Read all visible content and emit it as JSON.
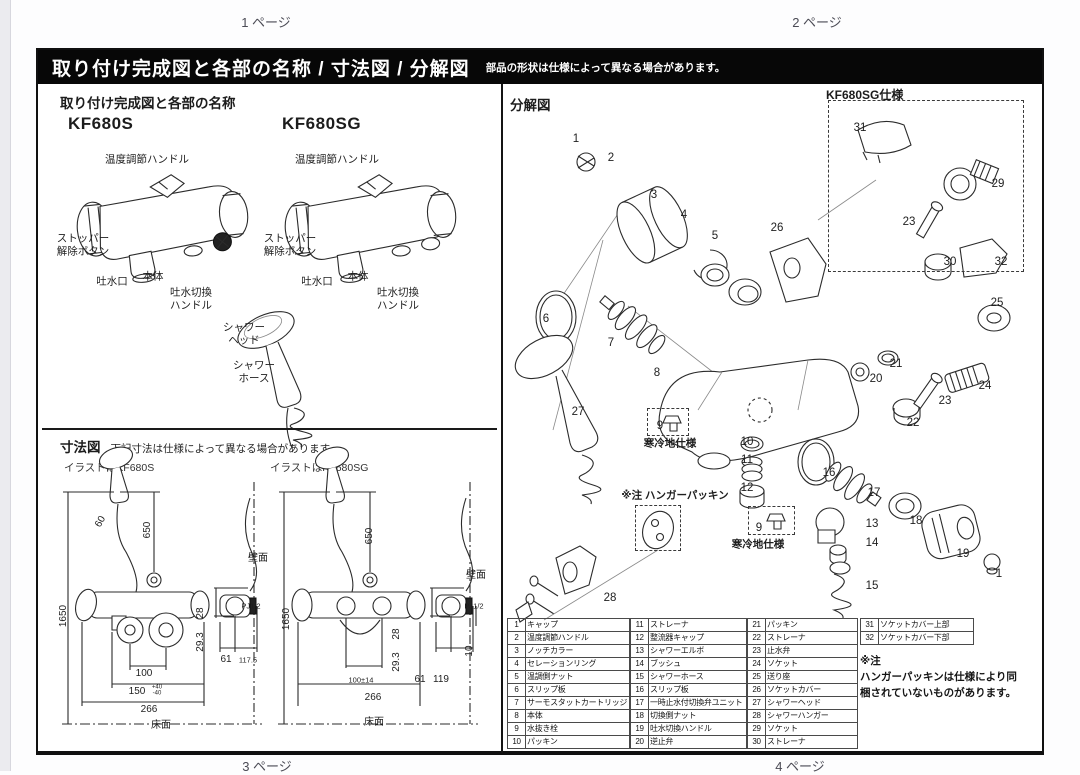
{
  "viewer": {
    "top_pages": [
      "1 ページ",
      "2 ページ"
    ],
    "bottom_pages": [
      "3 ページ",
      "4 ページ"
    ]
  },
  "header": {
    "title": "取り付け完成図と各部の名称 / 寸法図 / 分解図",
    "note": "部品の形状は仕様によって異なる場合があります。"
  },
  "completed": {
    "title": "取り付け完成図と各部の名称",
    "model_s": "KF680S",
    "model_sg": "KF680SG",
    "callouts": [
      {
        "t": "温度調節ハンドル",
        "x": 109,
        "y": 110
      },
      {
        "t": "ストッパー\n解除ボタン",
        "x": 45,
        "y": 195
      },
      {
        "t": "吐水口",
        "x": 74,
        "y": 232
      },
      {
        "t": "本体",
        "x": 115,
        "y": 227
      },
      {
        "t": "吐水切換\nハンドル",
        "x": 153,
        "y": 249
      },
      {
        "t": "温度調節ハンドル",
        "x": 299,
        "y": 110
      },
      {
        "t": "ストッパー\n解除ボタン",
        "x": 252,
        "y": 195
      },
      {
        "t": "吐水口",
        "x": 279,
        "y": 232
      },
      {
        "t": "本体",
        "x": 320,
        "y": 227
      },
      {
        "t": "吐水切換\nハンドル",
        "x": 360,
        "y": 249
      },
      {
        "t": "シャワー\nヘッド",
        "x": 206,
        "y": 284
      },
      {
        "t": "シャワー\nホース",
        "x": 216,
        "y": 322
      }
    ]
  },
  "dimensions": {
    "title": "寸法図",
    "note": "下記寸法は仕様によって異なる場合があります。",
    "caption_s": "イラストはKF680S",
    "caption_sg": "イラストはKF680SG",
    "wall_label": "壁面",
    "floor_label": "床面",
    "labels": [
      {
        "t": "650",
        "x": 110,
        "y": 480,
        "rot": 1
      },
      {
        "t": "1650",
        "x": 26,
        "y": 566,
        "rot": 1
      },
      {
        "t": "60",
        "x": 63,
        "y": 472,
        "cls": "dim-label rot60"
      },
      {
        "t": "100",
        "x": 106,
        "y": 624
      },
      {
        "t": "150",
        "x": 99,
        "y": 642
      },
      {
        "t": "+40\n-40",
        "x": 119,
        "y": 641,
        "cls": "tol"
      },
      {
        "t": "266",
        "x": 111,
        "y": 660
      },
      {
        "t": "28",
        "x": 163,
        "y": 563,
        "rot": 1
      },
      {
        "t": "29.3",
        "x": 163,
        "y": 592,
        "rot": 1
      },
      {
        "t": "61",
        "x": 188,
        "y": 610
      },
      {
        "t": "117.5",
        "x": 210,
        "y": 610,
        "cls": "dim-sm"
      },
      {
        "t": "PJ1/2",
        "x": 213,
        "y": 556,
        "cls": "dim-sm"
      },
      {
        "t": "壁面",
        "x": 220,
        "y": 509
      },
      {
        "t": "床面",
        "x": 123,
        "y": 676
      },
      {
        "t": "650",
        "x": 332,
        "y": 486,
        "rot": 1
      },
      {
        "t": "1650",
        "x": 249,
        "y": 569,
        "rot": 1
      },
      {
        "t": "100±14",
        "x": 323,
        "y": 630,
        "cls": "dim-sm"
      },
      {
        "t": "266",
        "x": 335,
        "y": 648
      },
      {
        "t": "28",
        "x": 359,
        "y": 584,
        "rot": 1
      },
      {
        "t": "29.3",
        "x": 359,
        "y": 612,
        "rot": 1
      },
      {
        "t": "61",
        "x": 382,
        "y": 630
      },
      {
        "t": "119",
        "x": 403,
        "y": 630
      },
      {
        "t": "10",
        "x": 432,
        "y": 601,
        "rot": 1
      },
      {
        "t": "PJ1/2",
        "x": 436,
        "y": 556,
        "cls": "dim-sm"
      },
      {
        "t": "壁面",
        "x": 438,
        "y": 526
      },
      {
        "t": "床面",
        "x": 336,
        "y": 673
      }
    ]
  },
  "exploded": {
    "title": "分解図",
    "sg_box_label": "KF680SG仕様",
    "cold_label_1": "寒冷地仕様",
    "cold_label_2": "寒冷地仕様",
    "hanger_label": "※注 ハンガーパッキン",
    "callouts": [
      {
        "n": "1",
        "x": 538,
        "y": 90
      },
      {
        "n": "2",
        "x": 573,
        "y": 109
      },
      {
        "n": "3",
        "x": 616,
        "y": 146
      },
      {
        "n": "4",
        "x": 646,
        "y": 166
      },
      {
        "n": "5",
        "x": 677,
        "y": 187
      },
      {
        "n": "26",
        "x": 739,
        "y": 179
      },
      {
        "n": "6",
        "x": 508,
        "y": 270
      },
      {
        "n": "7",
        "x": 573,
        "y": 294
      },
      {
        "n": "8",
        "x": 619,
        "y": 324
      },
      {
        "n": "27",
        "x": 540,
        "y": 363
      },
      {
        "n": "9",
        "x": 622,
        "y": 377
      },
      {
        "n": "10",
        "x": 709,
        "y": 393
      },
      {
        "n": "11",
        "x": 709,
        "y": 411
      },
      {
        "n": "12",
        "x": 709,
        "y": 439
      },
      {
        "n": "28",
        "x": 572,
        "y": 549
      },
      {
        "n": "9",
        "x": 721,
        "y": 479
      },
      {
        "n": "13",
        "x": 834,
        "y": 475
      },
      {
        "n": "14",
        "x": 834,
        "y": 494
      },
      {
        "n": "15",
        "x": 834,
        "y": 537
      },
      {
        "n": "16",
        "x": 791,
        "y": 424
      },
      {
        "n": "17",
        "x": 836,
        "y": 444
      },
      {
        "n": "18",
        "x": 878,
        "y": 472
      },
      {
        "n": "19",
        "x": 925,
        "y": 505
      },
      {
        "n": "1",
        "x": 961,
        "y": 525
      },
      {
        "n": "20",
        "x": 838,
        "y": 330
      },
      {
        "n": "21",
        "x": 858,
        "y": 315
      },
      {
        "n": "22",
        "x": 875,
        "y": 374
      },
      {
        "n": "23",
        "x": 907,
        "y": 352
      },
      {
        "n": "24",
        "x": 947,
        "y": 337
      },
      {
        "n": "25",
        "x": 959,
        "y": 254
      },
      {
        "n": "31",
        "x": 822,
        "y": 79
      },
      {
        "n": "29",
        "x": 960,
        "y": 135
      },
      {
        "n": "23",
        "x": 871,
        "y": 173
      },
      {
        "n": "30",
        "x": 912,
        "y": 213
      },
      {
        "n": "32",
        "x": 963,
        "y": 213
      }
    ],
    "labels": [
      {
        "t": "寒冷地仕様",
        "x": 632,
        "y": 394,
        "cls": "bold-label"
      },
      {
        "t": "※注 ハンガーパッキン",
        "x": 637,
        "y": 446,
        "cls": "bold-label"
      },
      {
        "t": "寒冷地仕様",
        "x": 720,
        "y": 495,
        "cls": "bold-label"
      }
    ],
    "table_groups": [
      {
        "start": 1,
        "items": [
          "キャップ",
          "温度調節ハンドル",
          "ノッチカラー",
          "セレーションリング",
          "温調側ナット",
          "スリップ板",
          "サーモスタットカートリッジ",
          "本体",
          "水抜き栓",
          "パッキン"
        ]
      },
      {
        "start": 11,
        "items": [
          "ストレーナ",
          "整流器キャップ",
          "シャワーエルボ",
          "ブッシュ",
          "シャワーホース",
          "スリップ板",
          "一時止水付切換弁ユニット",
          "切換側ナット",
          "吐水切換ハンドル",
          "逆止弁"
        ]
      },
      {
        "start": 21,
        "items": [
          "パッキン",
          "ストレーナ",
          "止水弁",
          "ソケット",
          "送り座",
          "ソケットカバー",
          "シャワーヘッド",
          "シャワーハンガー",
          "ソケット",
          "ストレーナ"
        ]
      },
      {
        "start": 31,
        "items": [
          "ソケットカバー上部",
          "ソケットカバー下部"
        ]
      }
    ],
    "table_note": "※注\nハンガーパッキンは仕様により同\n梱されていないものがあります。"
  }
}
